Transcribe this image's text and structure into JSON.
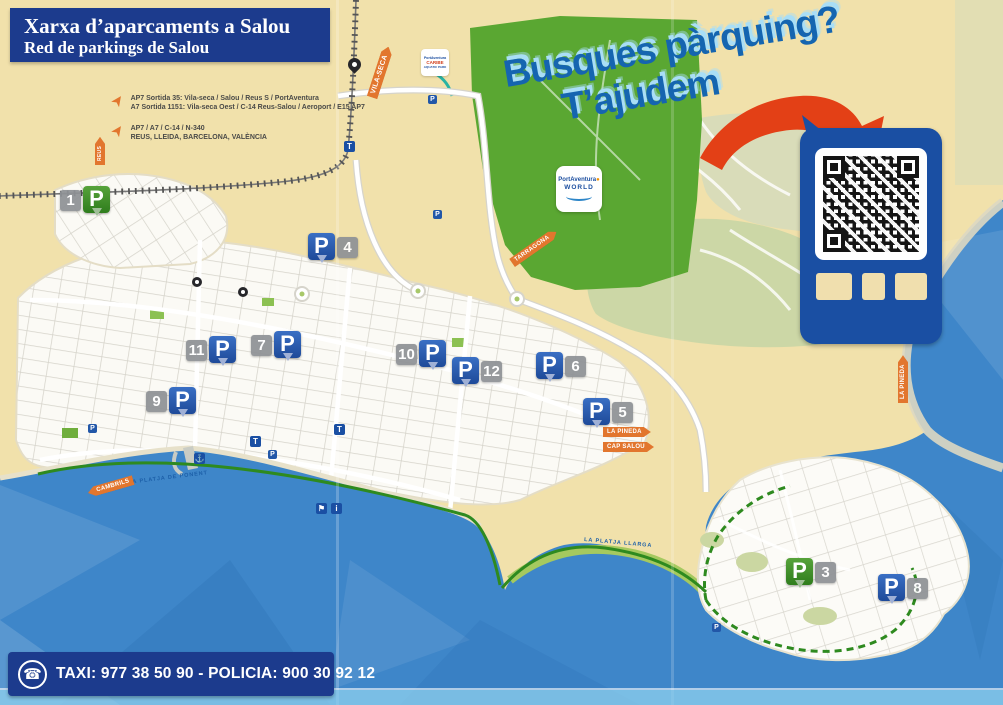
{
  "header": {
    "title": "Xarxa d’aparcaments a Salou",
    "subtitle": "Red de parkings de Salou"
  },
  "legend": {
    "exit1_line1": "AP7 Sortida 35: Vila-seca / Salou / Reus S / PortAventura",
    "exit1_line2": "A7 Sortida 1151: Vila-seca Oest / C-14 Reus-Salou / Aeroport / E15 AP7",
    "exit2_line1": "AP7 / A7 / C-14 / N-340",
    "exit2_line2": "REUS, LLEIDA, BARCELONA, VALÈNCIA"
  },
  "promo": {
    "line1": "Busques pàrquing?",
    "line2": "T’ajudem"
  },
  "road_signs": {
    "vila_seca": "VILA-SECA",
    "tarragona": "TARRAGONA",
    "reus": "REUS",
    "la_pineda": "LA PINEDA",
    "cap_salou": "CAP SALOU",
    "cambrils": "CAMBRILS",
    "la_pineda_vertical": "LA PINEDA"
  },
  "sea_labels": {
    "ponent": "LA PLATJA DE PONENT",
    "llarga": "LA PLATJA LLARGA"
  },
  "logos": {
    "portaventura_line1": "PortAventura",
    "portaventura_line2": "WORLD",
    "caribe_line1": "PortAventura",
    "caribe_line2": "CARIBE",
    "caribe_line3": "AQUATIC PARK"
  },
  "markers": {
    "p_letter": "P",
    "m1": {
      "number": "1",
      "color": "green",
      "number_side": "left"
    },
    "m3": {
      "number": "3",
      "color": "green",
      "number_side": "right"
    },
    "m4": {
      "number": "4",
      "color": "blue",
      "number_side": "right"
    },
    "m5": {
      "number": "5",
      "color": "blue",
      "number_side": "right"
    },
    "m6": {
      "number": "6",
      "color": "blue",
      "number_side": "right"
    },
    "m7": {
      "number": "7",
      "color": "blue",
      "number_side": "left"
    },
    "m8": {
      "number": "8",
      "color": "blue",
      "number_side": "right"
    },
    "m9": {
      "number": "9",
      "color": "blue",
      "number_side": "left"
    },
    "m10": {
      "number": "10",
      "color": "blue",
      "number_side": "left"
    },
    "m11": {
      "number": "11",
      "color": "blue",
      "number_side": "left"
    },
    "m12": {
      "number": "12",
      "color": "blue",
      "number_side": "right"
    }
  },
  "icons": {
    "phone": "☎",
    "train": "T",
    "anchor": "⚓",
    "flag": "⚑",
    "info": "i"
  },
  "footer": {
    "text": "TAXI: 977 38 50 90  -  POLICIA: 900 30 92 12"
  },
  "colors": {
    "title_blue": "#1c3b8d",
    "marker_blue": "#1e4a99",
    "marker_green": "#2f7d1d",
    "sign_orange": "#e2762e",
    "sea_blue": "#3e86c9",
    "park_green": "#5aa732",
    "land_cream": "#f1e1ab",
    "promo_blue": "#1565b0",
    "promo_shadow": "#a9def6",
    "arrow_red": "#e34016"
  }
}
